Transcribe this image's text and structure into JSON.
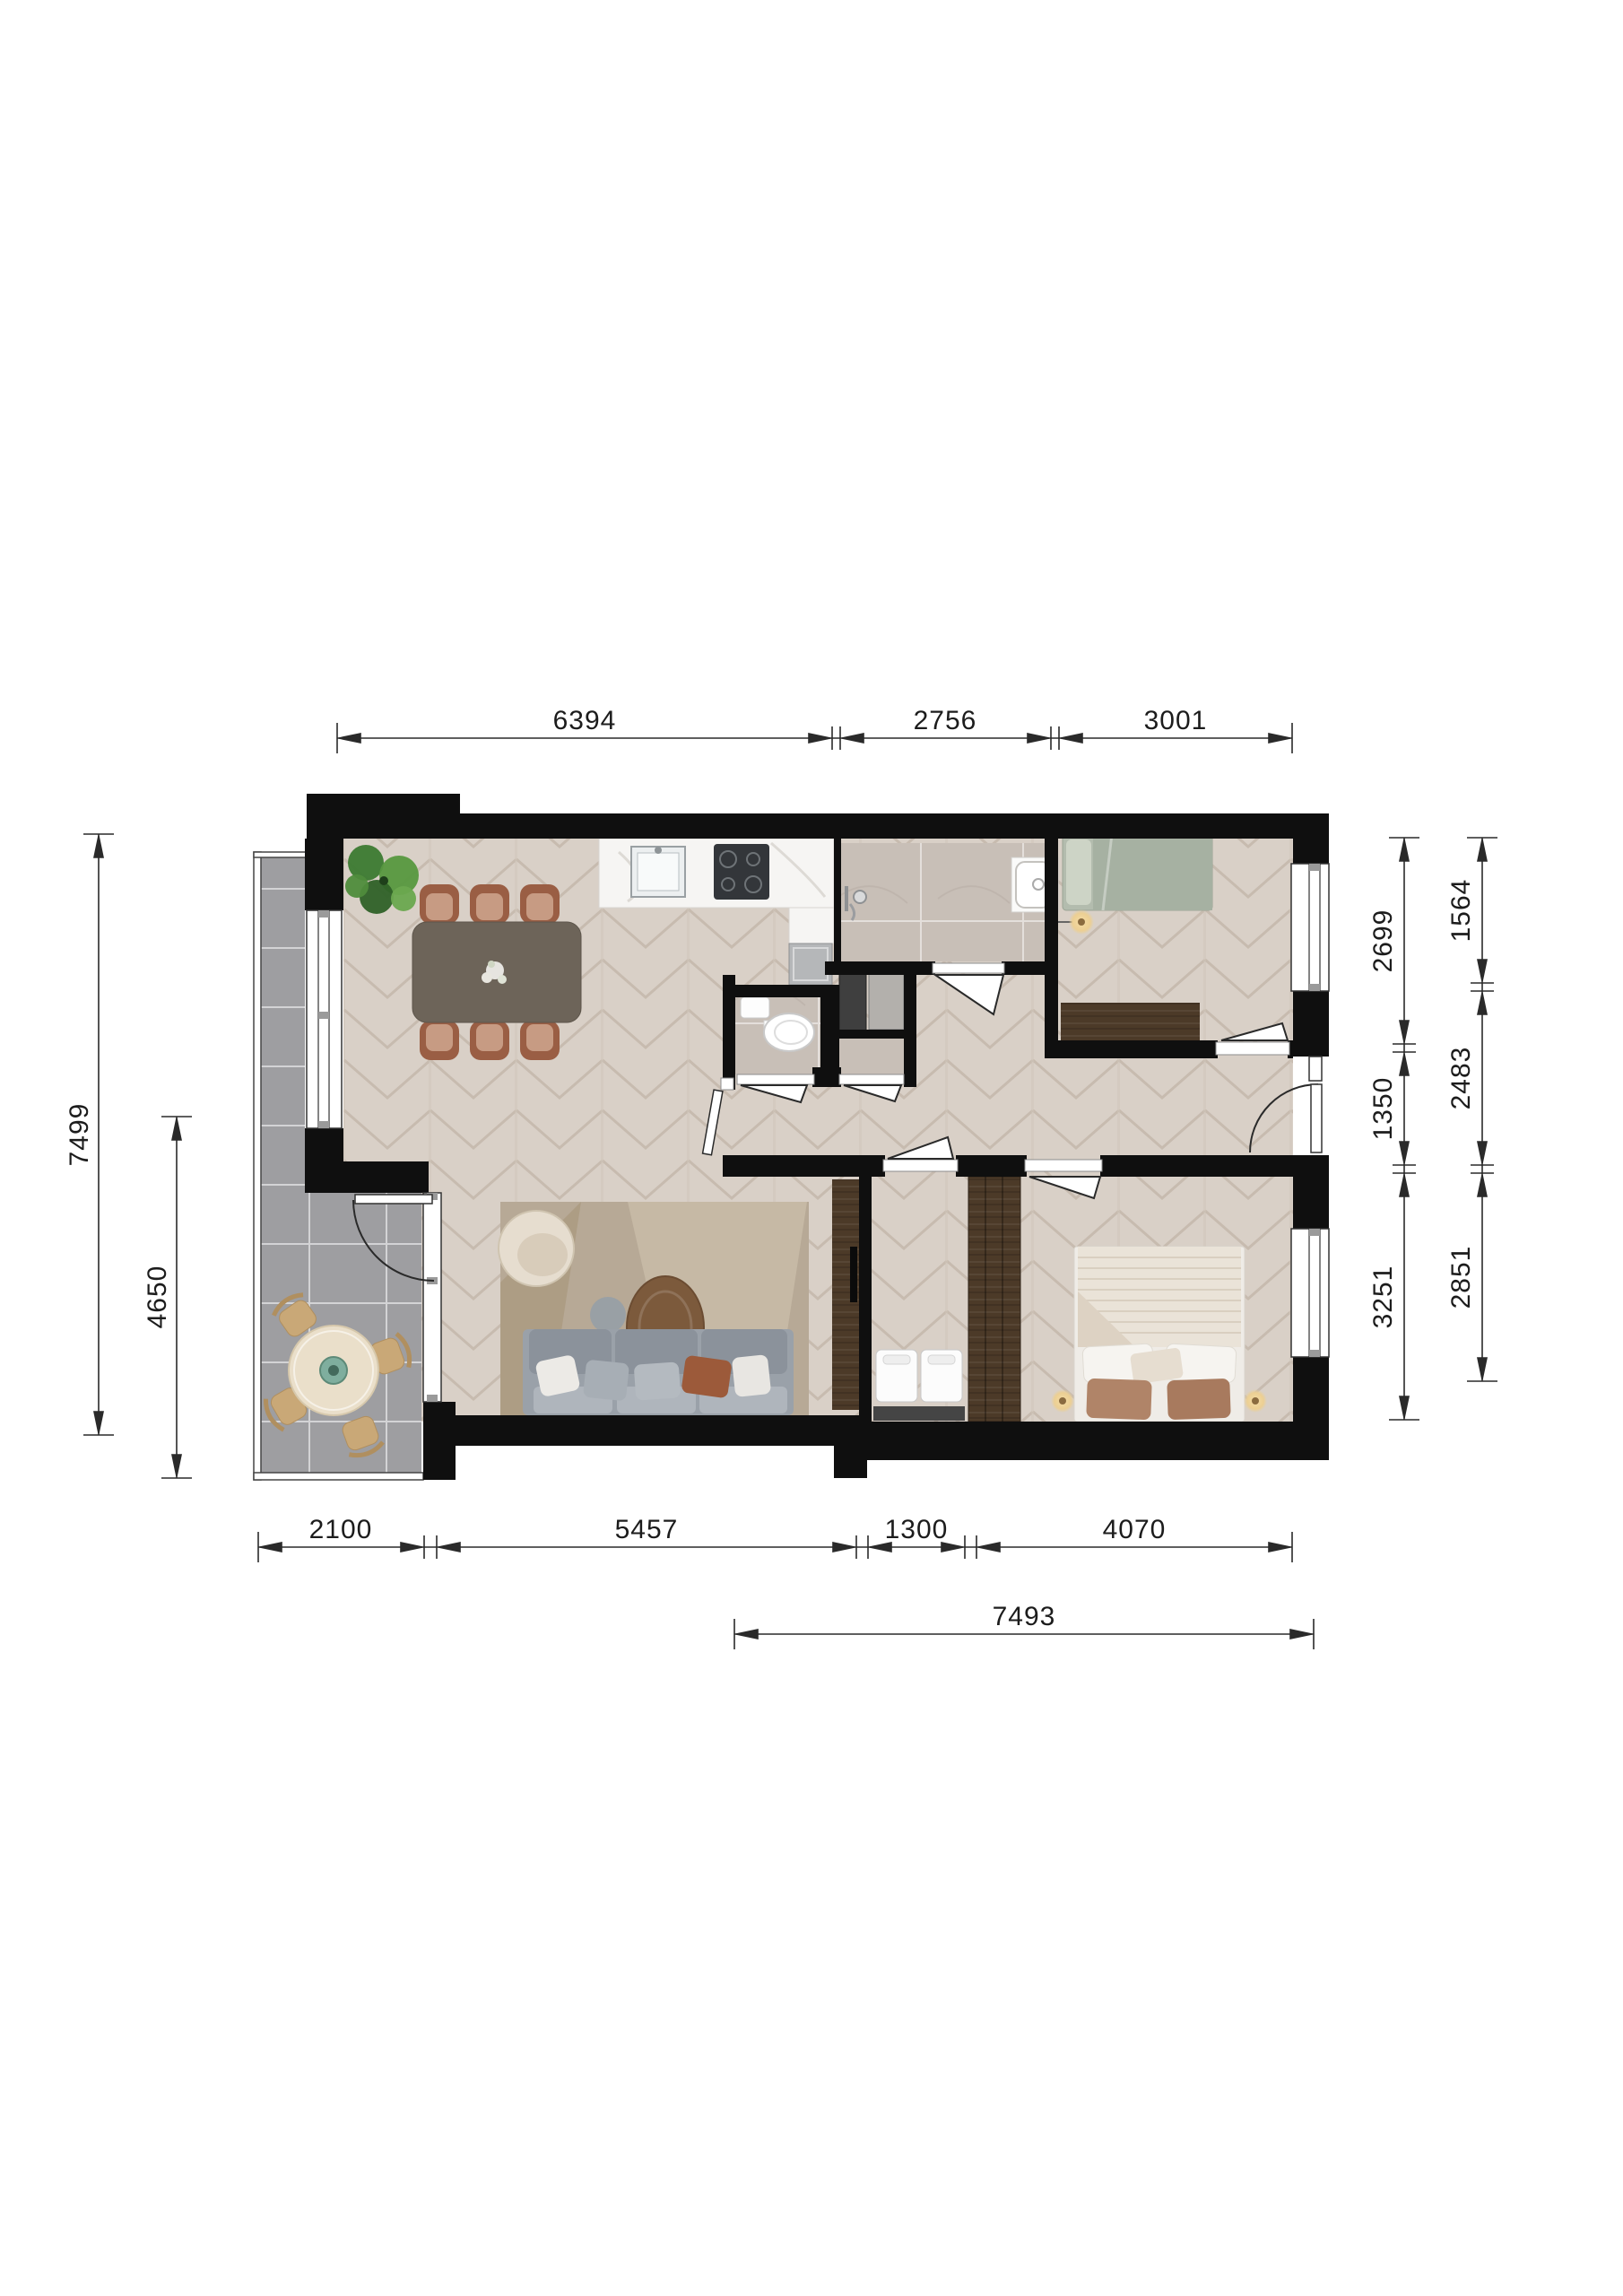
{
  "document": {
    "type": "apartment-floor-plan",
    "units": "mm"
  },
  "dims": {
    "top": [
      "6394",
      "2756",
      "3001"
    ],
    "left": [
      "7499",
      "4650"
    ],
    "right_inner": [
      "2699",
      "1350",
      "3251"
    ],
    "right_outer": [
      "1564",
      "2483",
      "2851"
    ],
    "bottom": [
      "2100",
      "5457",
      "1300",
      "4070"
    ],
    "bottom_total": "7493"
  },
  "colors": {
    "wall": "#0f0f0f",
    "chevron_floor": "#d9d0c7",
    "bathroom_tile": "#c8bfb7",
    "balcony_tile": "#9e9ea1",
    "wood_dark": "#4c3a28",
    "sage_bed": "#a9b4a5",
    "rust_chair": "#9a5e44",
    "sofa_gray": "#9aa1a9",
    "dim_line": "#2a2a2a"
  },
  "furniture": [
    "dining-table",
    "dining-chair",
    "plant",
    "kitchen-sink",
    "cooktop",
    "kitchen-counter",
    "appliance",
    "shower-set",
    "washbasin",
    "toilet",
    "washer",
    "dryer",
    "tv-cabinet",
    "tv",
    "armchair",
    "rug",
    "coffee-table",
    "side-table",
    "sofa",
    "bed-single",
    "pendant-lamp",
    "desk",
    "wardrobe",
    "bed-double",
    "bedside-lamp",
    "balcony-table",
    "balcony-chair"
  ]
}
